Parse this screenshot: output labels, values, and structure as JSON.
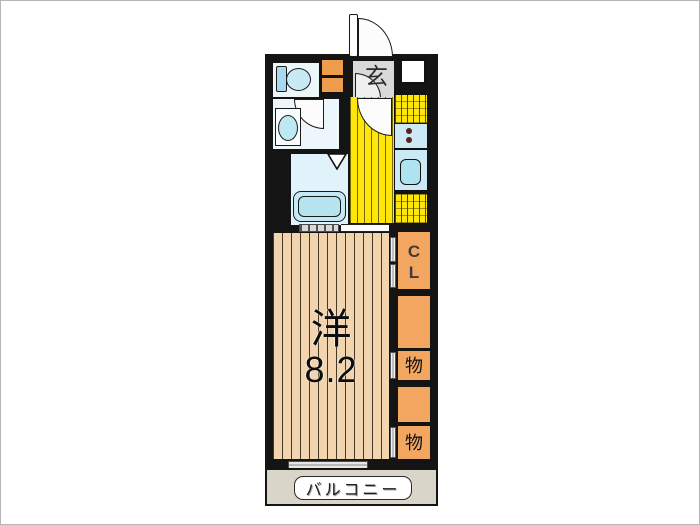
{
  "floor_plan": {
    "main_room": {
      "name_kanji": "洋",
      "size": "8.2"
    },
    "balcony": {
      "label": "バルコニー"
    },
    "entrance": {
      "label": "玄"
    },
    "closet": {
      "line1": "C",
      "line2": "L"
    },
    "storage_front": {
      "label": "物"
    },
    "storage_back": {
      "label": "物"
    },
    "colors": {
      "wall": "#141414",
      "room_floor": "#F2D5AF",
      "kitchen_floor": "#FFE60A",
      "closet_fill": "#F2A660",
      "shoe_cabinet_fill": "#EE9D4D",
      "entrance_fill": "#D9D9D9",
      "balcony_fill": "#D9D5C9",
      "fixture_blue": "#C5E9F4",
      "wet_floor": "#EDF6FB"
    }
  }
}
